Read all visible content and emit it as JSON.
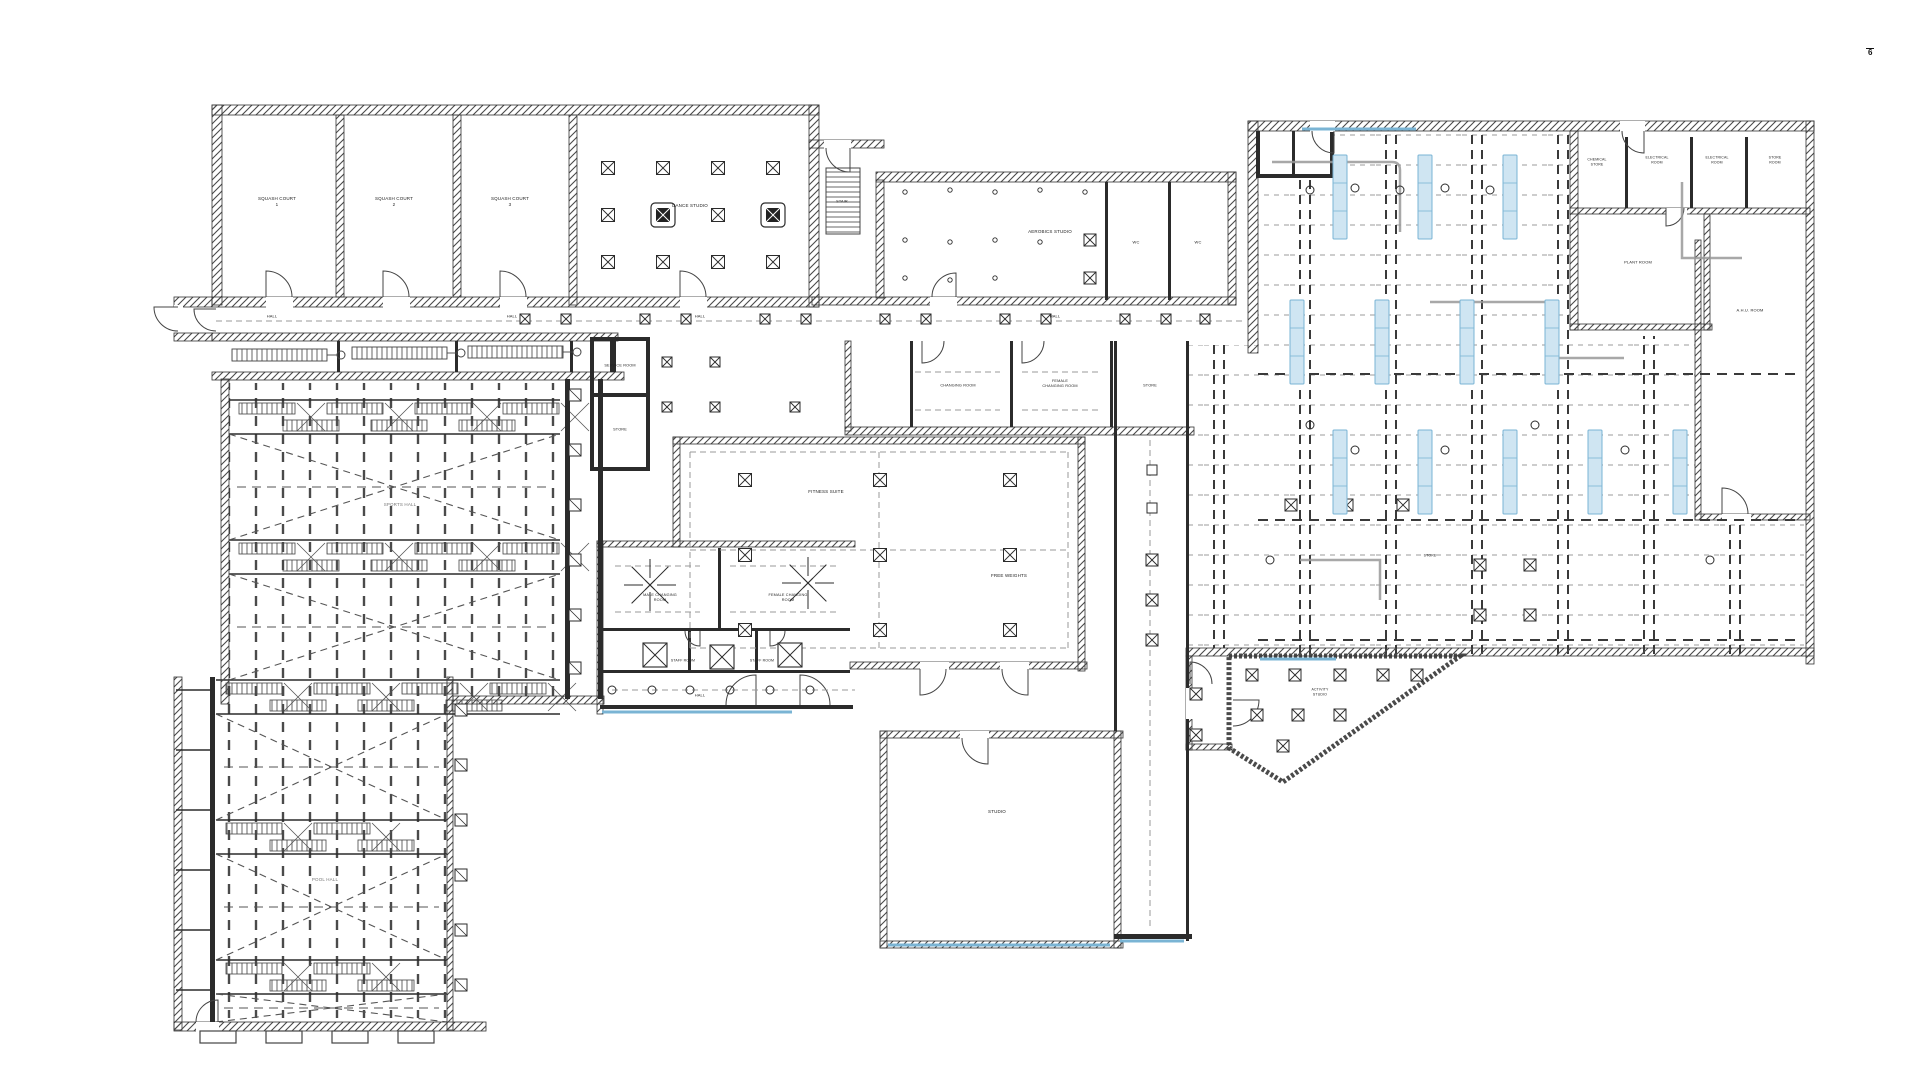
{
  "document": {
    "page_mark": "6"
  },
  "colors": {
    "ink": "#2b2b2b",
    "gray_line": "#999999",
    "hatch": "#4a4a4a",
    "blue_fill": "#cfe5f2",
    "blue_line": "#7ab4d4"
  },
  "legend_icons": {
    "ceiling_diffuser": "crossed-square",
    "light_strip": "blue-rectangle",
    "sprinkler": "small-circle",
    "extract_fan": "radial-arrows",
    "column": "boxed-square"
  },
  "labels": [
    {
      "text": "SQUASH COURT\n1",
      "x": 277,
      "y": 202,
      "s": 4.5
    },
    {
      "text": "SQUASH COURT\n2",
      "x": 394,
      "y": 202,
      "s": 4.5
    },
    {
      "text": "SQUASH COURT\n3",
      "x": 510,
      "y": 202,
      "s": 4.5
    },
    {
      "text": "DANCE STUDIO",
      "x": 690,
      "y": 206,
      "s": 4.5
    },
    {
      "text": "HALL",
      "x": 272,
      "y": 316,
      "s": 4
    },
    {
      "text": "HALL",
      "x": 512,
      "y": 316,
      "s": 4
    },
    {
      "text": "HALL",
      "x": 700,
      "y": 316,
      "s": 4
    },
    {
      "text": "HALL",
      "x": 1055,
      "y": 316,
      "s": 4
    },
    {
      "text": "SERVICE ROOM",
      "x": 620,
      "y": 366,
      "s": 3.8
    },
    {
      "text": "STORE",
      "x": 620,
      "y": 430,
      "s": 3.8
    },
    {
      "text": "STAIR",
      "x": 842,
      "y": 202,
      "s": 3.8
    },
    {
      "text": "AEROBICS STUDIO",
      "x": 1050,
      "y": 232,
      "s": 4.5
    },
    {
      "text": "WC",
      "x": 1136,
      "y": 242,
      "s": 4
    },
    {
      "text": "WC",
      "x": 1198,
      "y": 242,
      "s": 4
    },
    {
      "text": "CHANGING ROOM",
      "x": 958,
      "y": 386,
      "s": 3.8
    },
    {
      "text": "FEMALE\nCHANGING ROOM",
      "x": 1060,
      "y": 384,
      "s": 3.8
    },
    {
      "text": "STORE",
      "x": 1150,
      "y": 386,
      "s": 3.8
    },
    {
      "text": "FITNESS SUITE",
      "x": 826,
      "y": 492,
      "s": 4.5
    },
    {
      "text": "FREE WEIGHTS",
      "x": 1009,
      "y": 576,
      "s": 4.5
    },
    {
      "text": "MALE CHANGING\nROOM",
      "x": 660,
      "y": 598,
      "s": 3.8
    },
    {
      "text": "FEMALE CHANGING\nROOM",
      "x": 788,
      "y": 598,
      "s": 3.8
    },
    {
      "text": "STAFF ROOM",
      "x": 683,
      "y": 661,
      "s": 3.5
    },
    {
      "text": "STAFF ROOM",
      "x": 762,
      "y": 661,
      "s": 3.5
    },
    {
      "text": "HALL",
      "x": 700,
      "y": 695,
      "s": 4
    },
    {
      "text": "STUDIO",
      "x": 997,
      "y": 812,
      "s": 4.5
    },
    {
      "text": "SPORTS HALL",
      "x": 400,
      "y": 505,
      "s": 4.5,
      "c": "gray"
    },
    {
      "text": "POOL HALL",
      "x": 325,
      "y": 880,
      "s": 4.5,
      "c": "gray"
    },
    {
      "text": "CHEMICAL\nSTORE",
      "x": 1597,
      "y": 162,
      "s": 3.5
    },
    {
      "text": "ELECTRICAL\nROOM",
      "x": 1657,
      "y": 160,
      "s": 3.5
    },
    {
      "text": "ELECTRICAL\nROOM",
      "x": 1717,
      "y": 160,
      "s": 3.5
    },
    {
      "text": "STORE\nROOM",
      "x": 1775,
      "y": 160,
      "s": 3.5
    },
    {
      "text": "PLANT ROOM",
      "x": 1638,
      "y": 262,
      "s": 4
    },
    {
      "text": "A.H.U. ROOM",
      "x": 1750,
      "y": 310,
      "s": 4
    },
    {
      "text": "ACTIVITY\nSTUDIO",
      "x": 1320,
      "y": 692,
      "s": 3.5
    },
    {
      "text": "STORE",
      "x": 1430,
      "y": 556,
      "s": 3.5
    }
  ]
}
